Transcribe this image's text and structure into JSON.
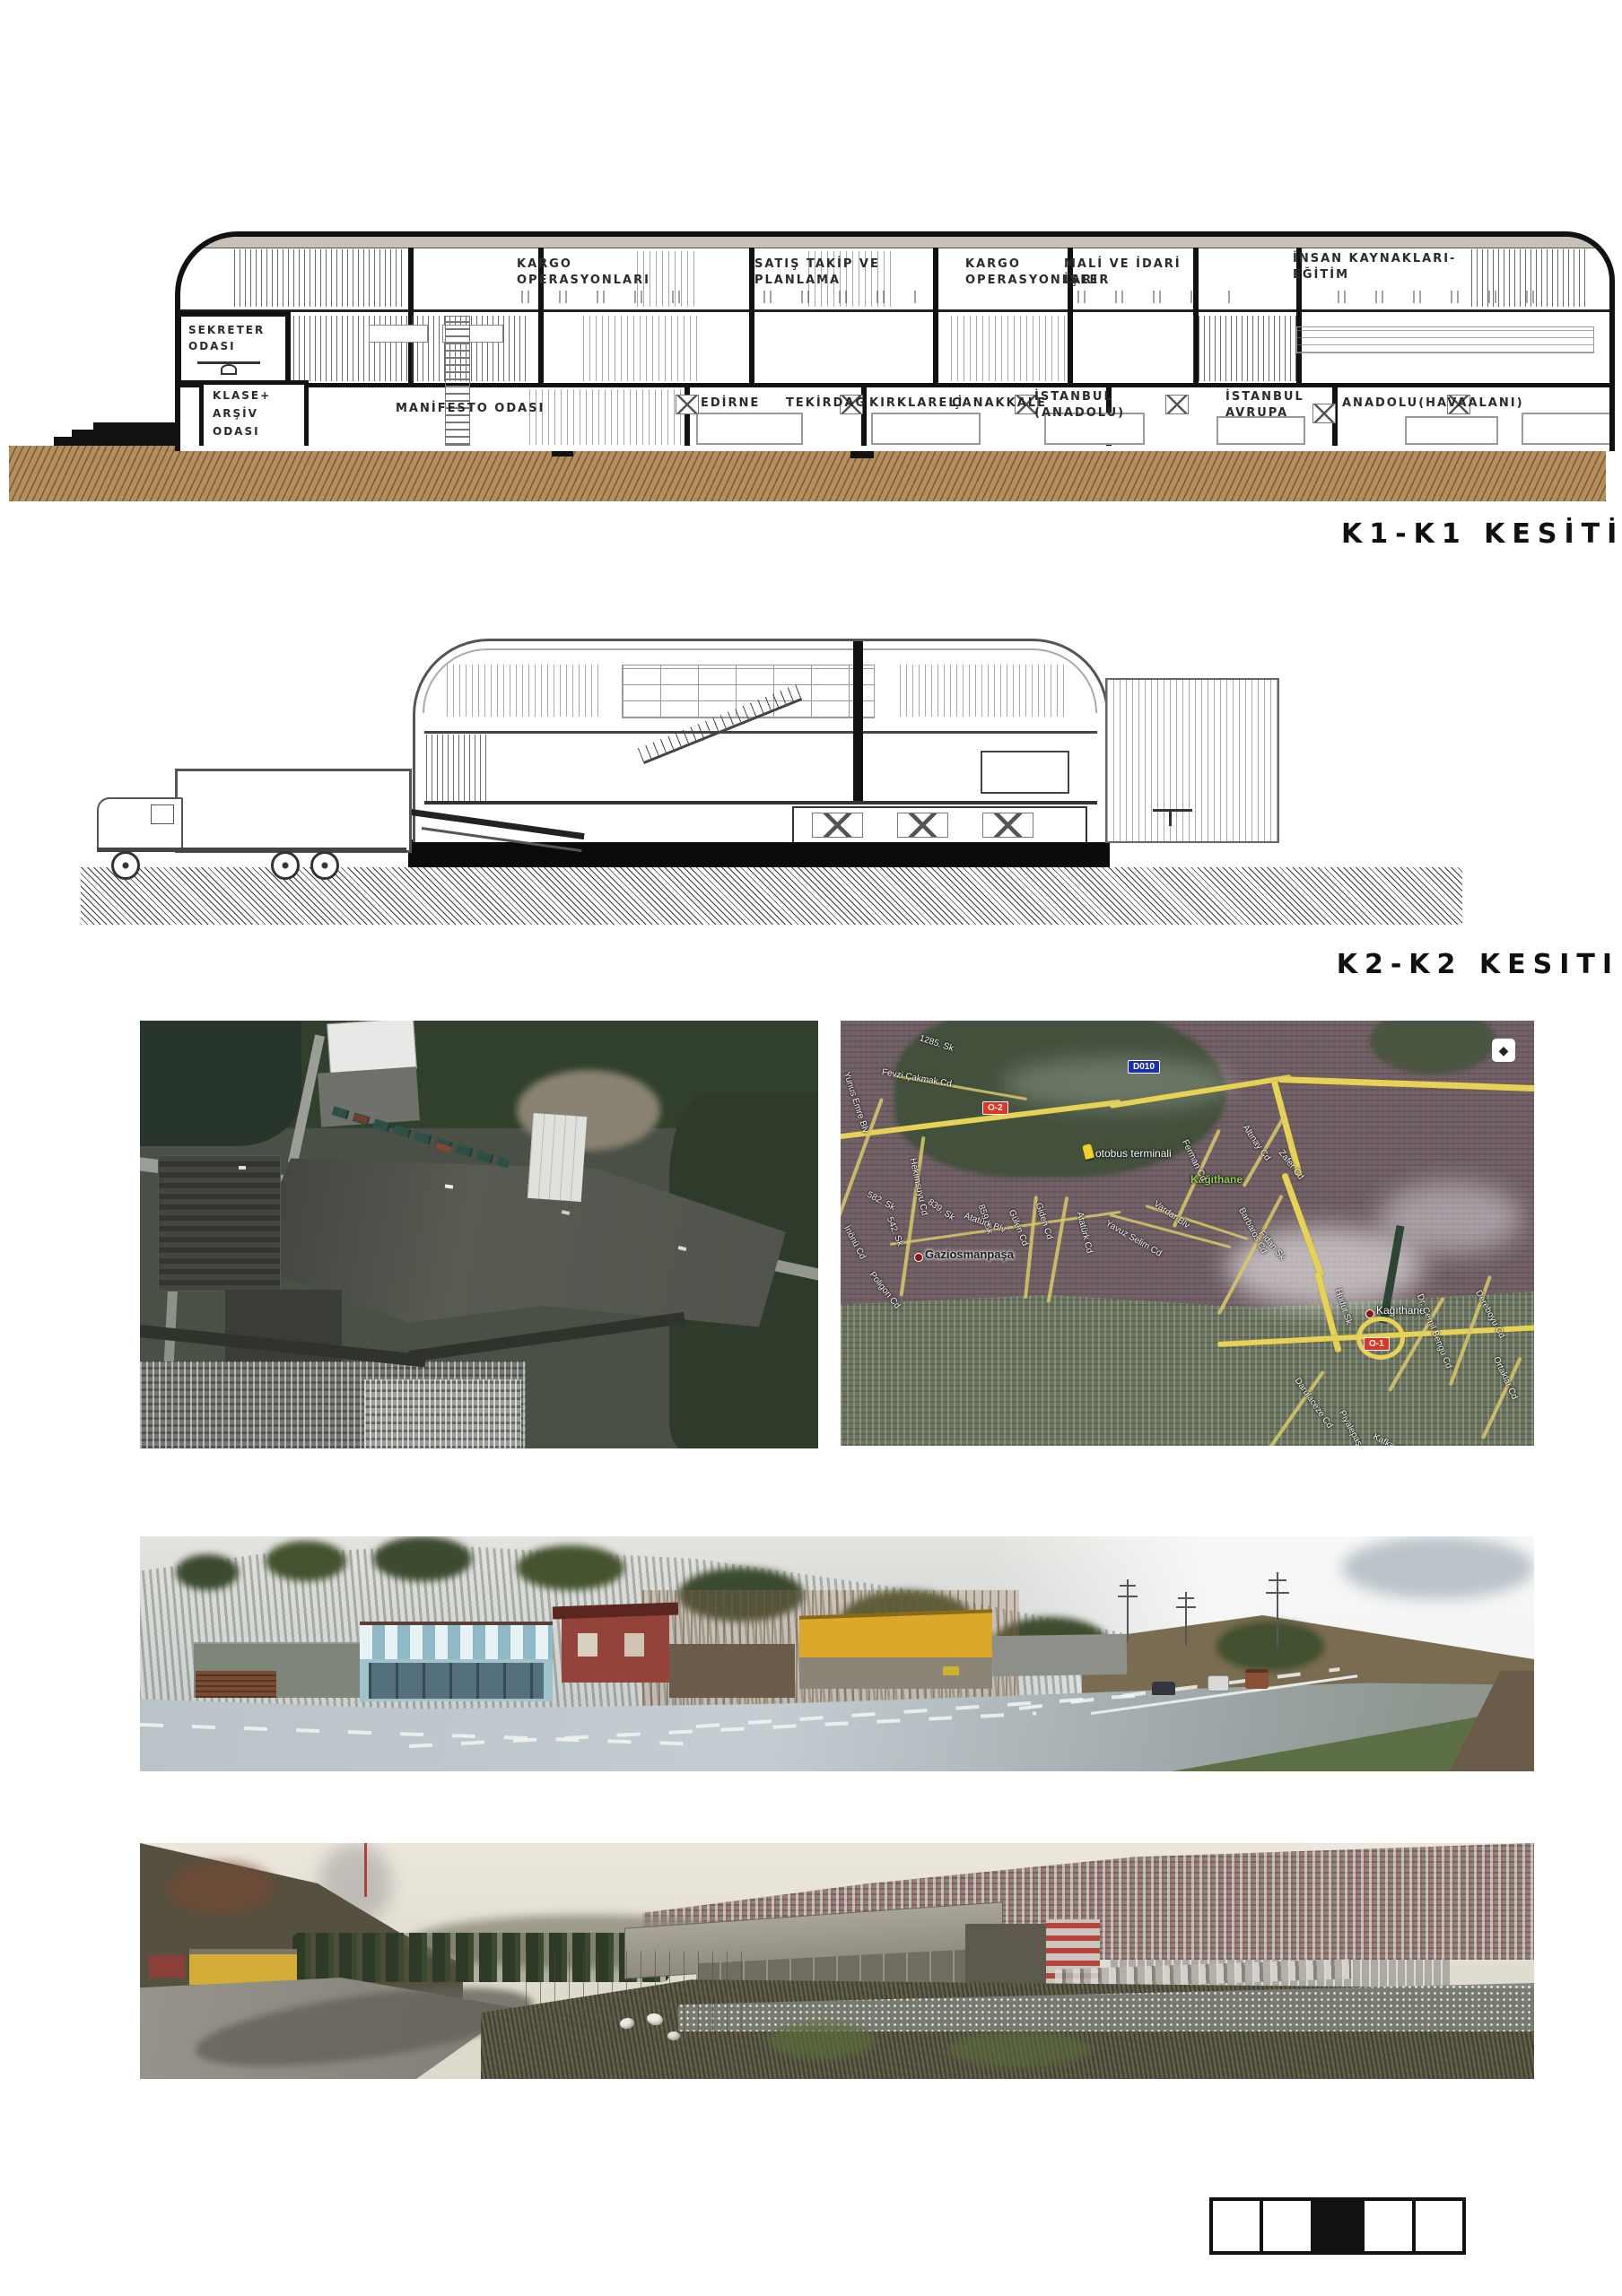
{
  "board": {
    "title_k1": "K1-K1 KESİTİ",
    "title_k2": "K2-K2 KESITI"
  },
  "section_k1": {
    "rooms_upper": [
      {
        "l1": "KARGO",
        "l2": "OPERASYONLARI"
      },
      {
        "l1": "SATIŞ TAKİP VE",
        "l2": "PLANLAMA"
      },
      {
        "l1": "KARGO",
        "l2": "OPERASYONLARI"
      },
      {
        "l1": "MALİ VE İDARİ",
        "l2": "İŞLER"
      },
      {
        "l1": "İNSAN KAYNAKLARI-",
        "l2": "EĞİTİM"
      }
    ],
    "rooms_left": {
      "sekreter_l1": "SEKRETER",
      "sekreter_l2": "ODASI",
      "klase_l1": "KLASE+",
      "klase_l2": "ARŞİV",
      "klase_l3": "ODASI",
      "manifesto": "MANİFESTO ODASI"
    },
    "rooms_lower": [
      {
        "l1": "EDİRNE"
      },
      {
        "l1": "TEKİRDAĞ"
      },
      {
        "l1": "KIRKLARELİ"
      },
      {
        "l1": "ÇANAKKALE"
      },
      {
        "l1": "İSTANBUL",
        "l2": "(ANADOLU)"
      },
      {
        "l1": "İSTANBUL",
        "l2": "AVRUPA"
      },
      {
        "l1": "ANADOLU(HAVAALANI)"
      }
    ]
  },
  "maps": {
    "right": {
      "badges": [
        {
          "label": "O-2",
          "color": "#e03424"
        },
        {
          "label": "D010",
          "color": "#1e2fae"
        },
        {
          "label": "O-1",
          "color": "#e03424"
        }
      ],
      "places": {
        "terminal": "otobus terminali",
        "gaziosmanpasa": "Gaziosmanpaşa",
        "kagithane_district": "Kağıthane",
        "kagithane_point": "Kağıthane"
      },
      "streets": [
        "1285. Sk",
        "Fevzi Çakmak Cd",
        "Yunus Emre Blv",
        "Hekimsuyu Cd",
        "839. Sk",
        "859. Sk",
        "582. Sk",
        "542. Sk",
        "İnönü Cd",
        "Poligon Cd",
        "Gülen Cd",
        "Giden Cd",
        "Atatürk Blv",
        "Atatürk Cd",
        "Yavuz Selim Cd",
        "Ferman Cd",
        "Altınay Cd",
        "Zafer Cd",
        "Barbaros Cd",
        "Fidan Sk",
        "Vardar Blv",
        "Dereboyu Cd",
        "Dr. Cemil Bengü Cd",
        "Darülaceze Cd",
        "Piyalepaşa Blv",
        "Kafka Sk",
        "Ortaklar Cd",
        "Hudut Sk"
      ],
      "colors": {
        "road_major": "#e7d258",
        "badge_red": "#e03424",
        "badge_blue": "#1e2fae",
        "district_green": "#8fd14f"
      },
      "logo_glyph": "◆"
    }
  },
  "scalebar": {
    "segments": 5,
    "filled_segment": 3
  }
}
